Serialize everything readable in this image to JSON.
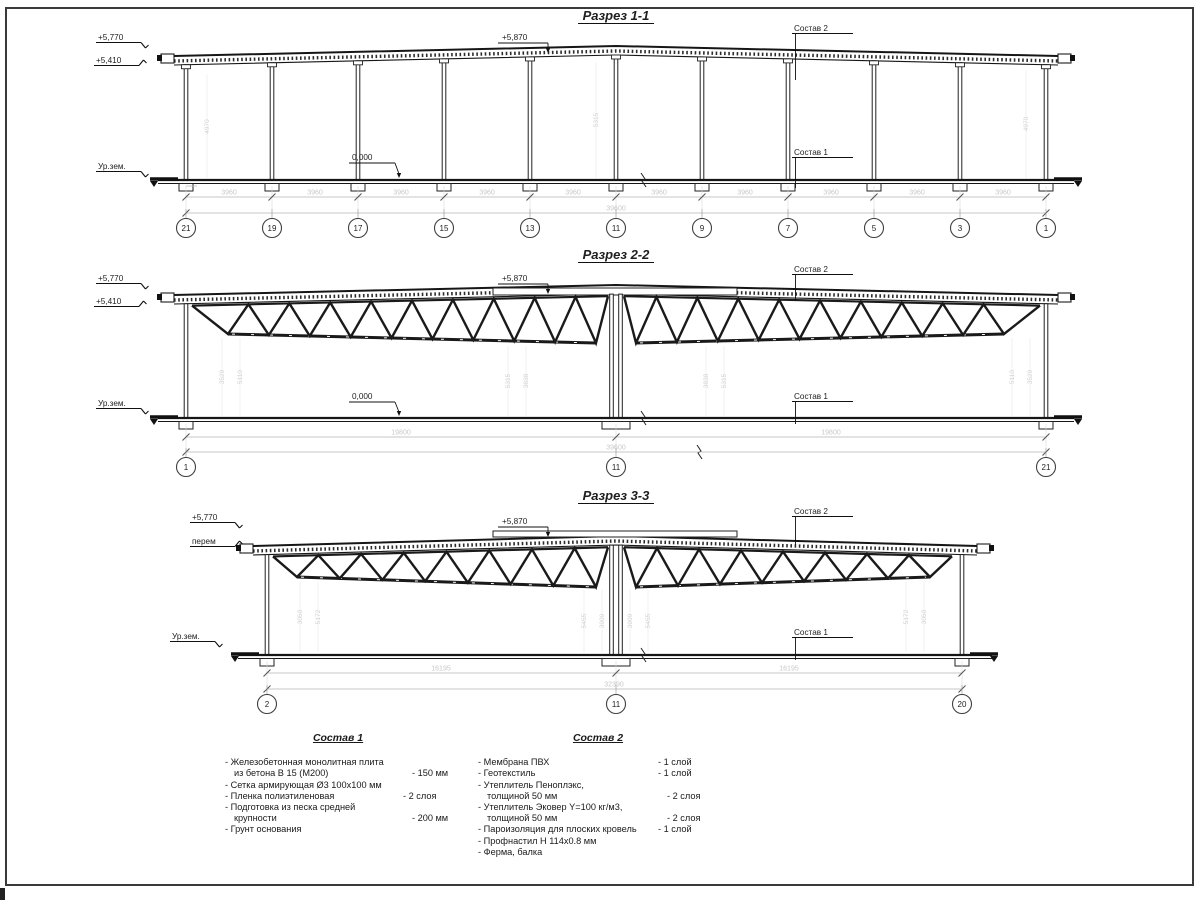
{
  "s1": {
    "title": "Разрез 1-1",
    "level_top": "+5,770",
    "level_eave": "+5,410",
    "level_peak": "+5,870",
    "level_zero": "0,000",
    "ground_label": "Ур.зем.",
    "layer_roof_label": "Состав 2",
    "layer_floor_label": "Состав 1",
    "bay_dims": [
      "3960",
      "3960",
      "3960",
      "3960",
      "3960",
      "3960",
      "3960",
      "3960",
      "3960",
      "3960"
    ],
    "total_dim": "39600",
    "bubbles": [
      "21",
      "19",
      "17",
      "15",
      "13",
      "11",
      "9",
      "7",
      "5",
      "3",
      "1"
    ],
    "height_dims": [
      "4970",
      "5315",
      "4970"
    ]
  },
  "s2": {
    "title": "Разрез 2-2",
    "level_top": "+5,770",
    "level_eave": "+5,410",
    "level_peak": "+5,870",
    "level_zero": "0,000",
    "ground_label": "Ур.зем.",
    "layer_roof_label": "Состав 2",
    "layer_floor_label": "Состав 1",
    "span_dims": [
      "19800",
      "19800"
    ],
    "total_dim": "39600",
    "bubbles": [
      "1",
      "11",
      "21"
    ],
    "height_dims": [
      "3529",
      "5110",
      "5315",
      "3838",
      "3838",
      "5315",
      "5110",
      "3529"
    ]
  },
  "s3": {
    "title": "Разрез 3-3",
    "level_top": "+5,770",
    "level_eave": "перем",
    "level_peak": "+5,870",
    "ground_label": "Ур.зем.",
    "layer_roof_label": "Состав 2",
    "layer_floor_label": "Состав 1",
    "span_dims": [
      "16195",
      "16195"
    ],
    "total_dim": "32390",
    "bubbles": [
      "2",
      "11",
      "20"
    ],
    "height_dims": [
      "3050",
      "5172",
      "5455",
      "3909",
      "3909",
      "5455",
      "5172",
      "3050"
    ]
  },
  "comp1": {
    "title": "Состав 1",
    "lines": [
      {
        "text": "- Железобетонная  монолитная плита",
        "indent": false,
        "qty": ""
      },
      {
        "text": "из бетона В 15 (М200)",
        "indent": true,
        "qty": "- 150 мм"
      },
      {
        "text": "- Сетка армирующая Ø3 100x100 мм",
        "indent": false,
        "qty": ""
      },
      {
        "text": "- Пленка полиэтиленовая",
        "indent": false,
        "qty": "- 2 слоя"
      },
      {
        "text": "- Подготовка из песка средней",
        "indent": false,
        "qty": ""
      },
      {
        "text": "крупности",
        "indent": true,
        "qty": "- 200 мм"
      },
      {
        "text": "- Грунт основания",
        "indent": false,
        "qty": ""
      }
    ]
  },
  "comp2": {
    "title": "Состав 2",
    "lines": [
      {
        "text": "- Мембрана ПВХ",
        "indent": false,
        "qty": "- 1 слой"
      },
      {
        "text": "- Геотекстиль",
        "indent": false,
        "qty": "- 1 слой"
      },
      {
        "text": "- Утеплитель Пеноплэкс,",
        "indent": false,
        "qty": ""
      },
      {
        "text": "толщиной 50 мм",
        "indent": true,
        "qty": "- 2 слоя"
      },
      {
        "text": "- Утеплитель Эковер Y=100 кг/м3,",
        "indent": false,
        "qty": ""
      },
      {
        "text": "толщиной 50 мм",
        "indent": true,
        "qty": "- 2 слоя"
      },
      {
        "text": "- Пароизоляция для плоских кровель",
        "indent": false,
        "qty": "- 1 слой"
      },
      {
        "text": "- Профнастил Н 114x0.8 мм",
        "indent": false,
        "qty": ""
      },
      {
        "text": "- Ферма, балка",
        "indent": false,
        "qty": ""
      }
    ]
  }
}
